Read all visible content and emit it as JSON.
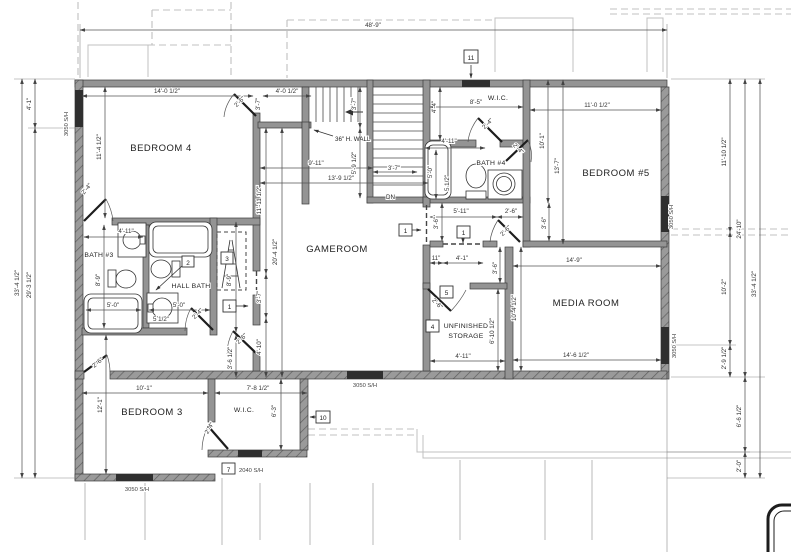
{
  "rooms": {
    "bedroom4": "BEDROOM 4",
    "bedroom3": "BEDROOM 3",
    "bedroom5": "BEDROOM #5",
    "gameroom": "GAMEROOM",
    "media": "MEDIA ROOM",
    "bath3": "BATH #3",
    "bath4": "BATH #4",
    "hall_bath": "HALL BATH",
    "wic": "W.I.C.",
    "storage1": "UNFINISHED",
    "storage2": "STORAGE"
  },
  "dims": {
    "d48_9": "48'-9\"",
    "d33_4h": "33'-4 1/2\"",
    "d29_3h": "29'-3 1/2\"",
    "d4_1": "4'-1\"",
    "d14_0h": "14'-0 1/2\"",
    "d4_0h": "4'-0 1/2\"",
    "d3_7": "3'-7\"",
    "d11_4h": "11'-4 1/2\"",
    "d9_11": "9'-11\"",
    "d13_9h": "13'-9 1/2\"",
    "d5_9h": "5'-9 1/2\"",
    "d11_11h": "11'-11 1/2\"",
    "d20_4h": "20'-4 1/2\"",
    "d4_10": "4'-10\"",
    "d3_6h": "3'-6 1/2\"",
    "d8_9": "8'-9\"",
    "d4_11": "4'-11\"",
    "d5_0": "5'-0\"",
    "d5h": "5 1/2\"",
    "d2_6": "2'-6\"",
    "d2_4": "2'-4\"",
    "d8_5": "8'-5\"",
    "d4_4": "4'-4\"",
    "d11_0h": "11'-0 1/2\"",
    "d10_1": "10'-1\"",
    "d13_7": "13'-7\"",
    "d5_11": "5'-11\"",
    "d3_6": "3'-6\"",
    "d11in": "11\"",
    "d14_9": "14'-9\"",
    "d14_6h": "14'-6 1/2\"",
    "d10_4h": "10'-4 1/2\"",
    "d6_10h": "6'-10 1/2\"",
    "d12_1": "12'-1\"",
    "d7_8h": "7'-8 1/2\"",
    "d6_3": "6'-3\"",
    "d11_10h": "11'-10 1/2\"",
    "d24_10": "24'-10\"",
    "d10_2": "10'-2\"",
    "d2_9h": "2'-9 1/2\"",
    "d6_6h": "6'-6 1/2\"",
    "d2_0": "2'-0\""
  },
  "windows": {
    "s3050": "3050 S/H",
    "s2040": "2040 S/H"
  },
  "callouts": {
    "n1": "1",
    "n2": "2",
    "n3": "3",
    "n4": "4",
    "n5": "5",
    "n7": "7",
    "n10": "10",
    "n11": "11"
  },
  "notes": {
    "dn": "DN",
    "half_wall": "36\" H. WALL"
  },
  "colors": {
    "wall_fill": "#949494",
    "line": "#3c3c3c",
    "dim_line": "#555555",
    "roof_line": "#c0c0c0",
    "text": "#222222",
    "background": "#ffffff"
  }
}
